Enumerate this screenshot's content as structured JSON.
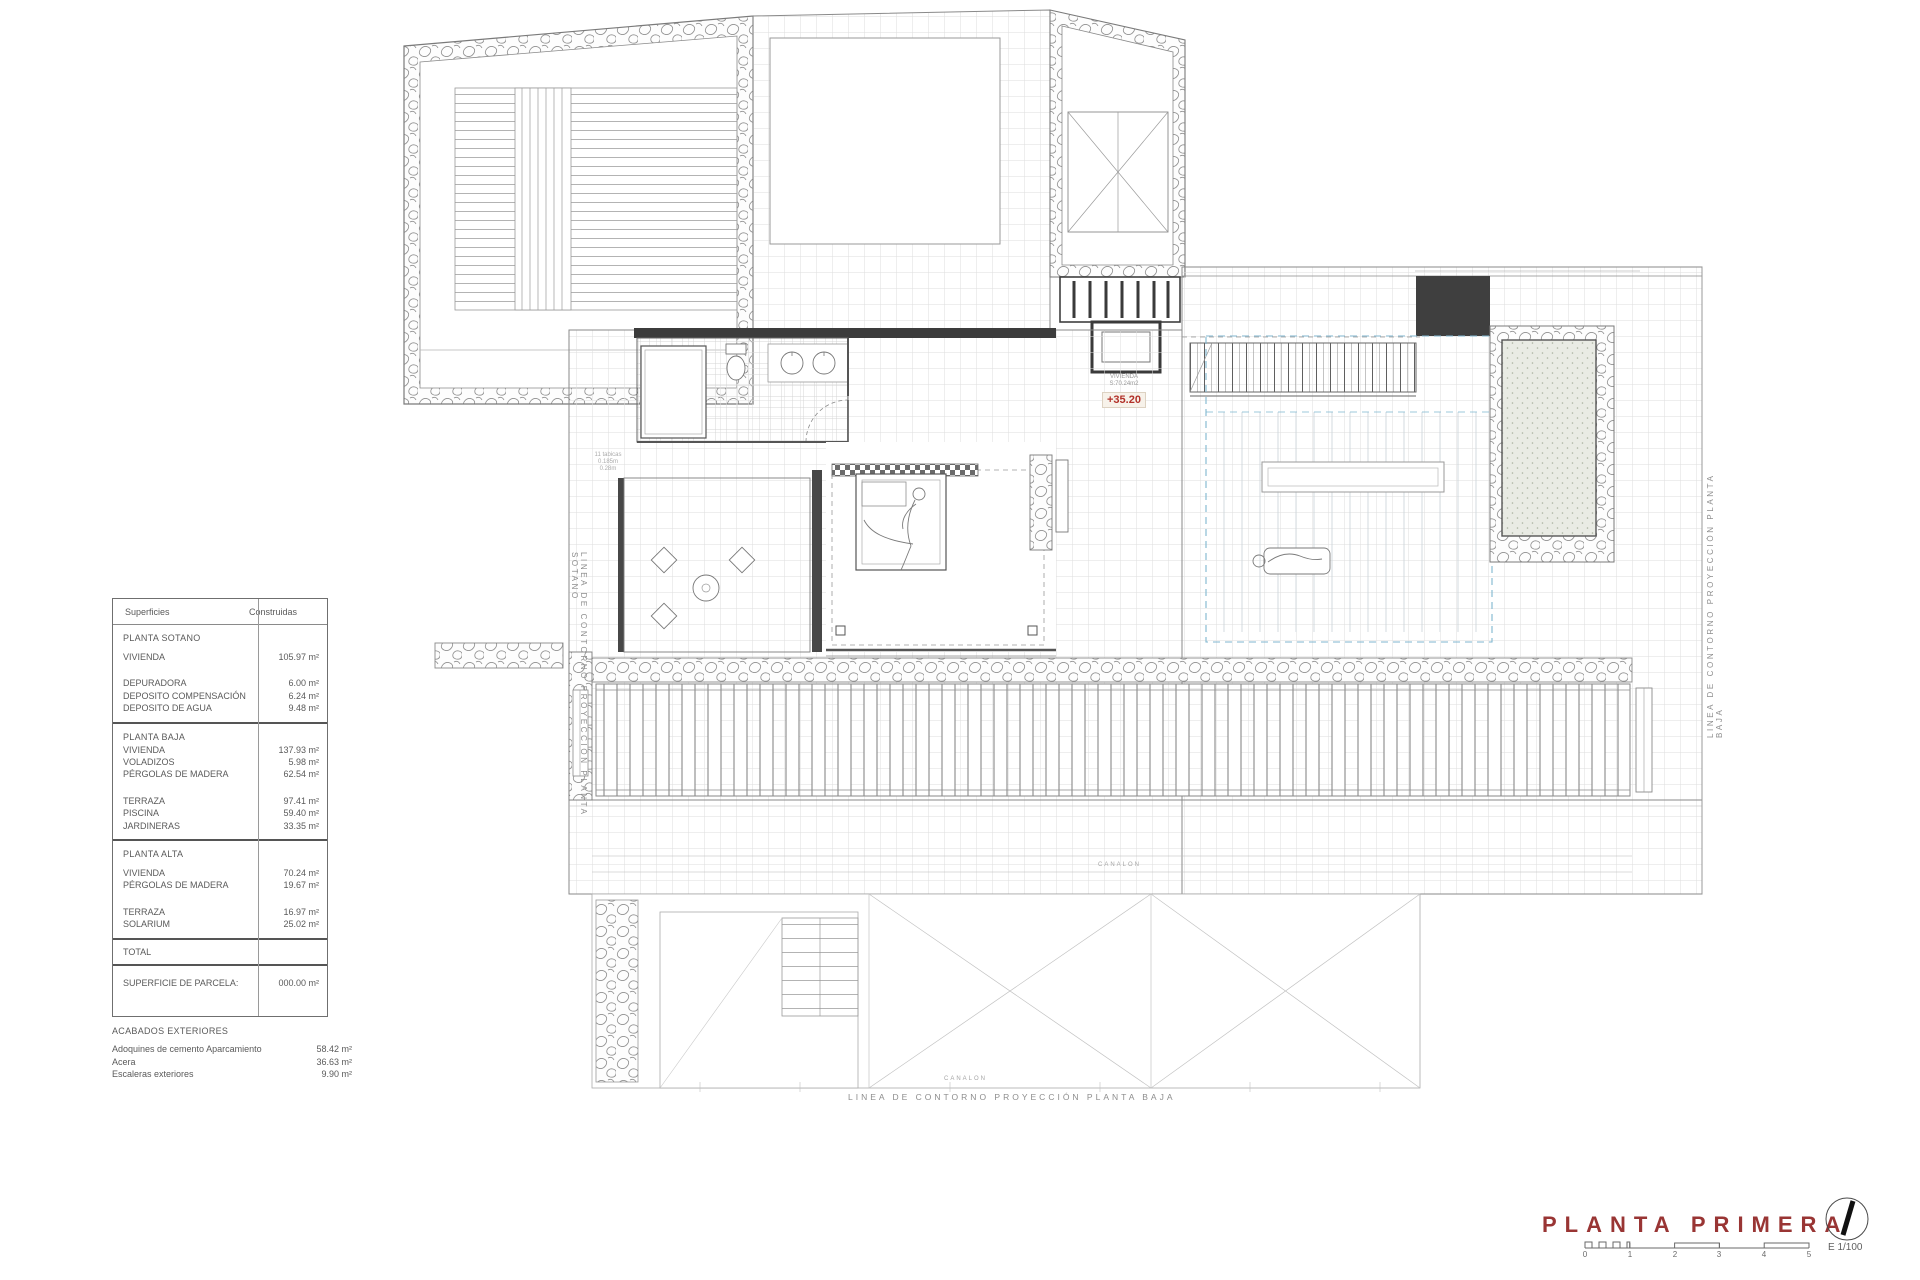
{
  "sheet": {
    "title": "PLANTA PRIMERA",
    "scale_label": "E 1/100"
  },
  "areas_table": {
    "col_labels": [
      "Superficies",
      "Construidas"
    ],
    "sections": [
      {
        "title": "PLANTA SOTANO",
        "groups": [
          [
            [
              "VIVIENDA",
              "105.97 m²"
            ]
          ],
          [
            [
              "DEPURADORA",
              "6.00 m²"
            ],
            [
              "DEPOSITO COMPENSACIÓN",
              "6.24 m²"
            ],
            [
              "DEPOSITO DE AGUA",
              "9.48 m²"
            ]
          ]
        ]
      },
      {
        "title": "PLANTA BAJA",
        "groups": [
          [
            [
              "VIVIENDA",
              "137.93 m²"
            ],
            [
              "VOLADIZOS",
              "5.98 m²"
            ],
            [
              "PÉRGOLAS DE MADERA",
              "62.54 m²"
            ]
          ],
          [
            [
              "TERRAZA",
              "97.41 m²"
            ],
            [
              "PISCINA",
              "59.40 m²"
            ],
            [
              "JARDINERAS",
              "33.35 m²"
            ]
          ]
        ]
      },
      {
        "title": "PLANTA ALTA",
        "groups": [
          [
            [
              "VIVIENDA",
              "70.24 m²"
            ],
            [
              "PÉRGOLAS DE MADERA",
              "19.67 m²"
            ]
          ],
          [
            [
              "TERRAZA",
              "16.97 m²"
            ],
            [
              "SOLARIUM",
              "25.02 m²"
            ]
          ]
        ]
      }
    ],
    "total_label": "TOTAL",
    "parcel": {
      "label": "SUPERFICIE DE PARCELA:",
      "value": "000.00 m²"
    }
  },
  "exterior_finishes": {
    "title": "ACABADOS EXTERIORES",
    "rows": [
      [
        "Adoquines de cemento Aparcamiento",
        "58.42 m²"
      ],
      [
        "Acera",
        "36.63 m²"
      ],
      [
        "Escaleras exteriores",
        "9.90 m²"
      ]
    ]
  },
  "plan_labels": {
    "room_name": "VIVIENDA",
    "room_area": "S:70.24m2",
    "level": "+35.20",
    "contour_sotano": "LINEA DE CONTORNO PROYECCIÓN PLANTA SOTANO",
    "contour_baja_right": "LINEA DE CONTORNO PROYECCIÓN PLANTA BAJA",
    "contour_baja_bottom": "LINEA DE CONTORNO PROYECCIÓN PLANTA BAJA",
    "gutter": "CANALON",
    "stair_note": [
      "11 tabicas",
      "0.185m",
      "0.28m"
    ]
  },
  "scale_bar": {
    "ticks": [
      "0",
      "1",
      "2",
      "3",
      "4",
      "5"
    ]
  },
  "colors": {
    "accent_red": "#b23129",
    "title_red": "#993534",
    "plan_blue": "#7fb6cf"
  }
}
